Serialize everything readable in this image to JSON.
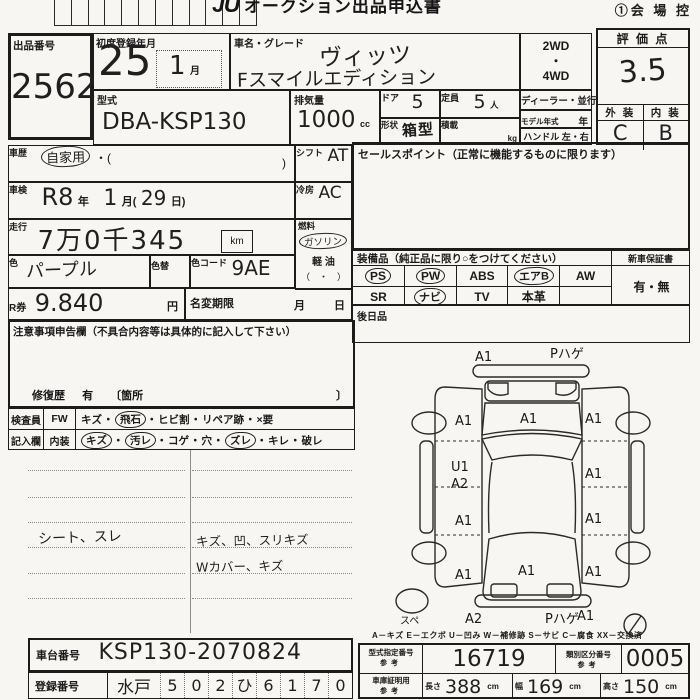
{
  "colors": {
    "paper": "#f7f6f2",
    "ink": "#1c1c1c"
  },
  "ui": {
    "dot": "・"
  },
  "header": {
    "title_logo": "JU",
    "title": "オークション出品申込書",
    "copy_label": "①会 場 控"
  },
  "lot": {
    "label": "出品番号",
    "value": "2562"
  },
  "first_registration": {
    "label": "初度登録年月",
    "year": "25",
    "month": "1",
    "month_unit": "月"
  },
  "vehicle": {
    "name_label": "車名・グレード",
    "name_line1": "ヴィッツ",
    "name_line2": "Fスマイルエディション",
    "drive1": "2WD",
    "drive_dot": "・",
    "drive2": "4WD",
    "model_code_label": "型式",
    "model_code": "DBA-KSP130",
    "displacement_label": "排気量",
    "displacement": "1000",
    "displacement_unit": "cc",
    "doors_label": "ドア",
    "doors": "5",
    "capacity_label": "定員",
    "capacity": "5",
    "capacity_unit": "人",
    "shape_label": "形状",
    "shape": "箱型",
    "load_label": "積載",
    "load_unit": "kg",
    "dealer_label": "ディーラー・並行",
    "model_year_label": "モデル年式",
    "model_year_unit": "年",
    "handle_label": "ハンドル 左・右"
  },
  "rating": {
    "header": "評 価 点",
    "score": "3.5",
    "exterior_label": "外 装",
    "interior_label": "内 装",
    "exterior": "C",
    "interior": "B"
  },
  "history": {
    "label": "車歴",
    "value": "自家用",
    "paren_open": "・(",
    "paren_close": ")"
  },
  "shift": {
    "label": "シフト",
    "value": "AT"
  },
  "inspection": {
    "label": "車検",
    "era": "R8",
    "year_unit": "年",
    "month": "1",
    "month_unit": "月(",
    "day": "29",
    "day_unit": "日)"
  },
  "aircon": {
    "label": "冷房",
    "value": "AC"
  },
  "mileage": {
    "label": "走行",
    "value": "7万0千345",
    "unit": "km"
  },
  "fuel": {
    "label": "燃料",
    "gasoline": "ガソリン",
    "diesel": "軽 油",
    "other": "（　・　）"
  },
  "color": {
    "label": "色",
    "value": "パープル",
    "change_label": "色替",
    "code_label": "色コード",
    "code": "9AE"
  },
  "ticket": {
    "label": "R券",
    "value": "9.840",
    "unit": "円"
  },
  "name_change": {
    "label": "名変期限",
    "month_unit": "月",
    "day_unit": "日"
  },
  "sales_point": {
    "label": "セールスポイント（正常に機能するものに限ります）"
  },
  "equipment": {
    "header": "装備品（純正品に限り○をつけてください）",
    "warranty_label": "新車保証書",
    "warranty_value": "有・無",
    "row1": [
      "PS",
      "PW",
      "ABS",
      "エアB",
      "AW"
    ],
    "row2": [
      "SR",
      "ナビ",
      "TV",
      "本革",
      ""
    ],
    "later_label": "後日品"
  },
  "notes": {
    "header": "注意事項申告欄（不具合内容等は具体的に記入して下さい）",
    "repair_label": "修復歴",
    "repair_value": "有",
    "repair_bracket": "〔箇所",
    "repair_close": "〕"
  },
  "inspector": {
    "col_label1": "検査員",
    "col_label2": "記入欄",
    "fw_label": "FW",
    "fw_items": [
      "キズ",
      "飛石",
      "ヒビ割",
      "リペア跡",
      "×要"
    ],
    "interior_label": "内装",
    "interior_items": [
      "キズ",
      "汚レ",
      "コゲ",
      "穴",
      "ズレ",
      "キレ",
      "破レ"
    ]
  },
  "memo": {
    "left_note": "シート、スレ",
    "right_note1": "キズ、凹、スリキズ",
    "right_note2": "Wカバー、キズ"
  },
  "chassis": {
    "label": "車台番号",
    "value": "KSP130-2070824"
  },
  "registration": {
    "label": "登録番号",
    "region": "水戸",
    "digits": [
      "5",
      "0",
      "2",
      "ひ",
      "6",
      "1",
      "7",
      "0"
    ]
  },
  "legend": "A－キズ  E－エクボ  U－凹み  W－補修跡  S－サビ  C－腐食  XX－交換済",
  "type_number": {
    "label": "型式指定番号",
    "sub": "参考",
    "value": "16719"
  },
  "class_number": {
    "label": "類別区分番号",
    "sub": "参考",
    "value": "0005"
  },
  "garage": {
    "label": "車庫証明用",
    "sub": "参考",
    "length_label": "長さ",
    "length": "388",
    "width_label": "幅",
    "width": "169",
    "height_label": "高さ",
    "height": "150",
    "unit": "cm"
  },
  "diagram": {
    "front_bumper_left": "A1",
    "front_bumper_right": "Pハゲ",
    "front_fender_left": "A1",
    "hood": "A1",
    "front_fender_right": "A1",
    "left_door_code1": "U1",
    "left_door_code2": "A2",
    "right_front_door": "A1",
    "left_rear_door": "A1",
    "right_rear_door": "A1",
    "rear_fender_left": "A1",
    "trunk": "A1",
    "rear_fender_right": "A1",
    "rear_bumper_left": "A2",
    "rear_bumper_center": "Pハゲ",
    "rear_bumper_right": "A1",
    "spare": "スペ"
  }
}
